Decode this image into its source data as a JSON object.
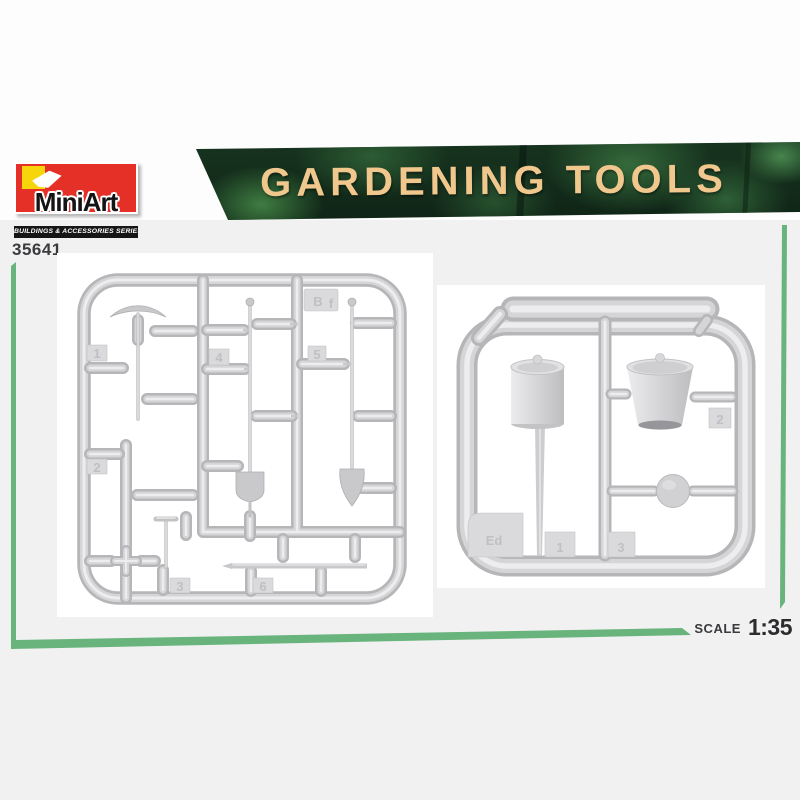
{
  "page": {
    "background": "#f1f1f2",
    "card_background": "#ffffff"
  },
  "header": {
    "logo": {
      "brand": "MiniArt",
      "series": "BUILDINGS & ACCESSORIES SERIES",
      "red": "#e53028",
      "yellow": "#f6d60a"
    },
    "sku": "35641",
    "banner": {
      "title": "GARDENING TOOLS",
      "text_color": "#f0c78d",
      "background_green": "#17341f"
    }
  },
  "accent": {
    "green": "#68b47c"
  },
  "footer": {
    "scale_label": "SCALE",
    "scale_value": "1:35"
  },
  "sprues": {
    "left": {
      "plate_code": "B",
      "plate_code_suffix": "f",
      "part_numbers": {
        "n1": "1",
        "n2": "2",
        "n3": "3",
        "n4": "4",
        "n5": "5",
        "n6": "6"
      }
    },
    "right": {
      "plate_code": "Ed",
      "part_numbers": {
        "n1": "1",
        "n2": "2",
        "n3": "3"
      }
    }
  }
}
